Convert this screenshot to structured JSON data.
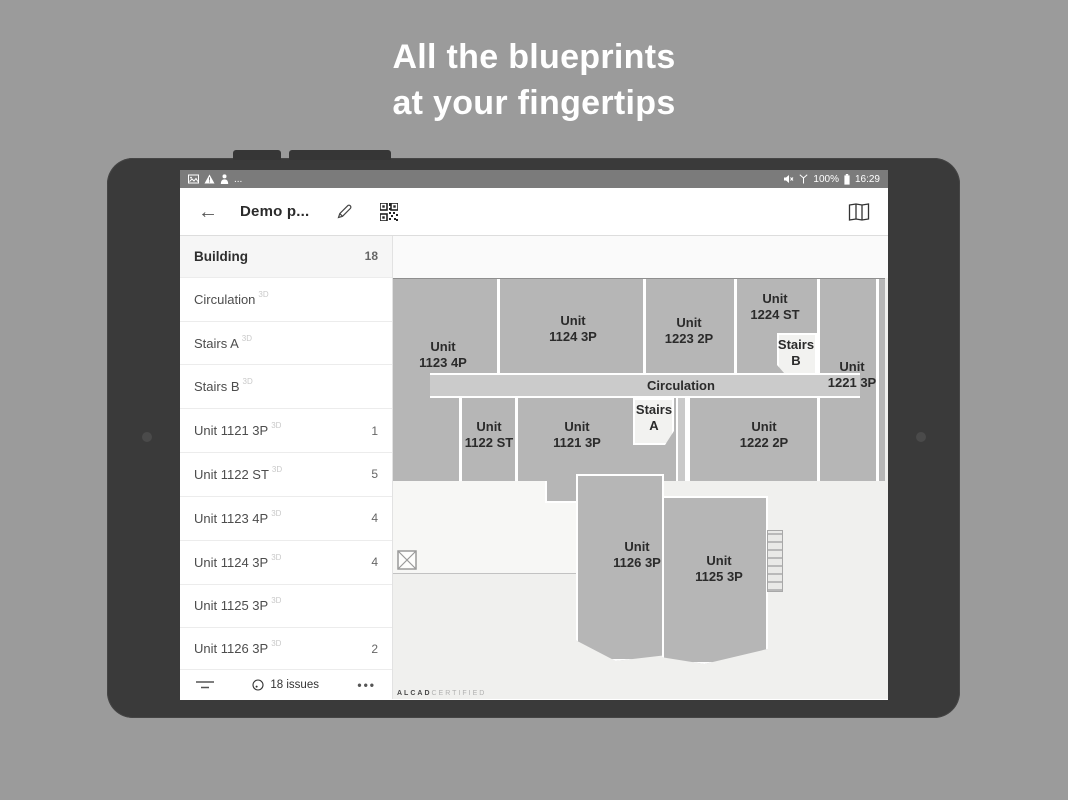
{
  "hero": {
    "line1": "All the blueprints",
    "line2": "at your fingertips"
  },
  "statusbar": {
    "left_more": "...",
    "battery_percent": "100%",
    "time": "16:29"
  },
  "header": {
    "back": "←",
    "title": "Demo p..."
  },
  "sidebar": {
    "items": [
      {
        "label": "Building",
        "sup": "",
        "count": "18"
      },
      {
        "label": "Circulation",
        "sup": "3D",
        "count": ""
      },
      {
        "label": "Stairs A",
        "sup": "3D",
        "count": ""
      },
      {
        "label": "Stairs B",
        "sup": "3D",
        "count": ""
      },
      {
        "label": "Unit 1121 3P",
        "sup": "3D",
        "count": "1"
      },
      {
        "label": "Unit 1122 ST",
        "sup": "3D",
        "count": "5"
      },
      {
        "label": "Unit 1123 4P",
        "sup": "3D",
        "count": "4"
      },
      {
        "label": "Unit 1124 3P",
        "sup": "3D",
        "count": "4"
      },
      {
        "label": "Unit 1125 3P",
        "sup": "3D",
        "count": ""
      },
      {
        "label": "Unit 1126 3P",
        "sup": "3D",
        "count": "2"
      }
    ],
    "footer": {
      "issues": "18 issues",
      "more": "•••"
    }
  },
  "plan": {
    "labels": [
      {
        "l1": "Unit",
        "l2": "1123 4P"
      },
      {
        "l1": "Unit",
        "l2": "1124 3P"
      },
      {
        "l1": "Unit",
        "l2": "1223 2P"
      },
      {
        "l1": "Unit",
        "l2": "1224 ST"
      },
      {
        "l1": "Stairs",
        "l2": "B"
      },
      {
        "l1": "Unit",
        "l2": "1221 3P"
      },
      {
        "l1": "Circulation",
        "l2": ""
      },
      {
        "l1": "Unit",
        "l2": "1122 ST"
      },
      {
        "l1": "Unit",
        "l2": "1121 3P"
      },
      {
        "l1": "Stairs",
        "l2": "A"
      },
      {
        "l1": "Unit",
        "l2": "1222 2P"
      },
      {
        "l1": "Unit",
        "l2": "1126 3P"
      },
      {
        "l1": "Unit",
        "l2": "1125 3P"
      }
    ],
    "watermark": {
      "bold": "ALCAD",
      "light": "CERTIFIED"
    }
  },
  "colors": {
    "page_bg": "#9b9b9b",
    "bezel": "#3a3a3a",
    "statusbar": "#7b7b7b",
    "unit_fill": "#b6b6b6",
    "corridor_fill": "#cbcbcb"
  }
}
